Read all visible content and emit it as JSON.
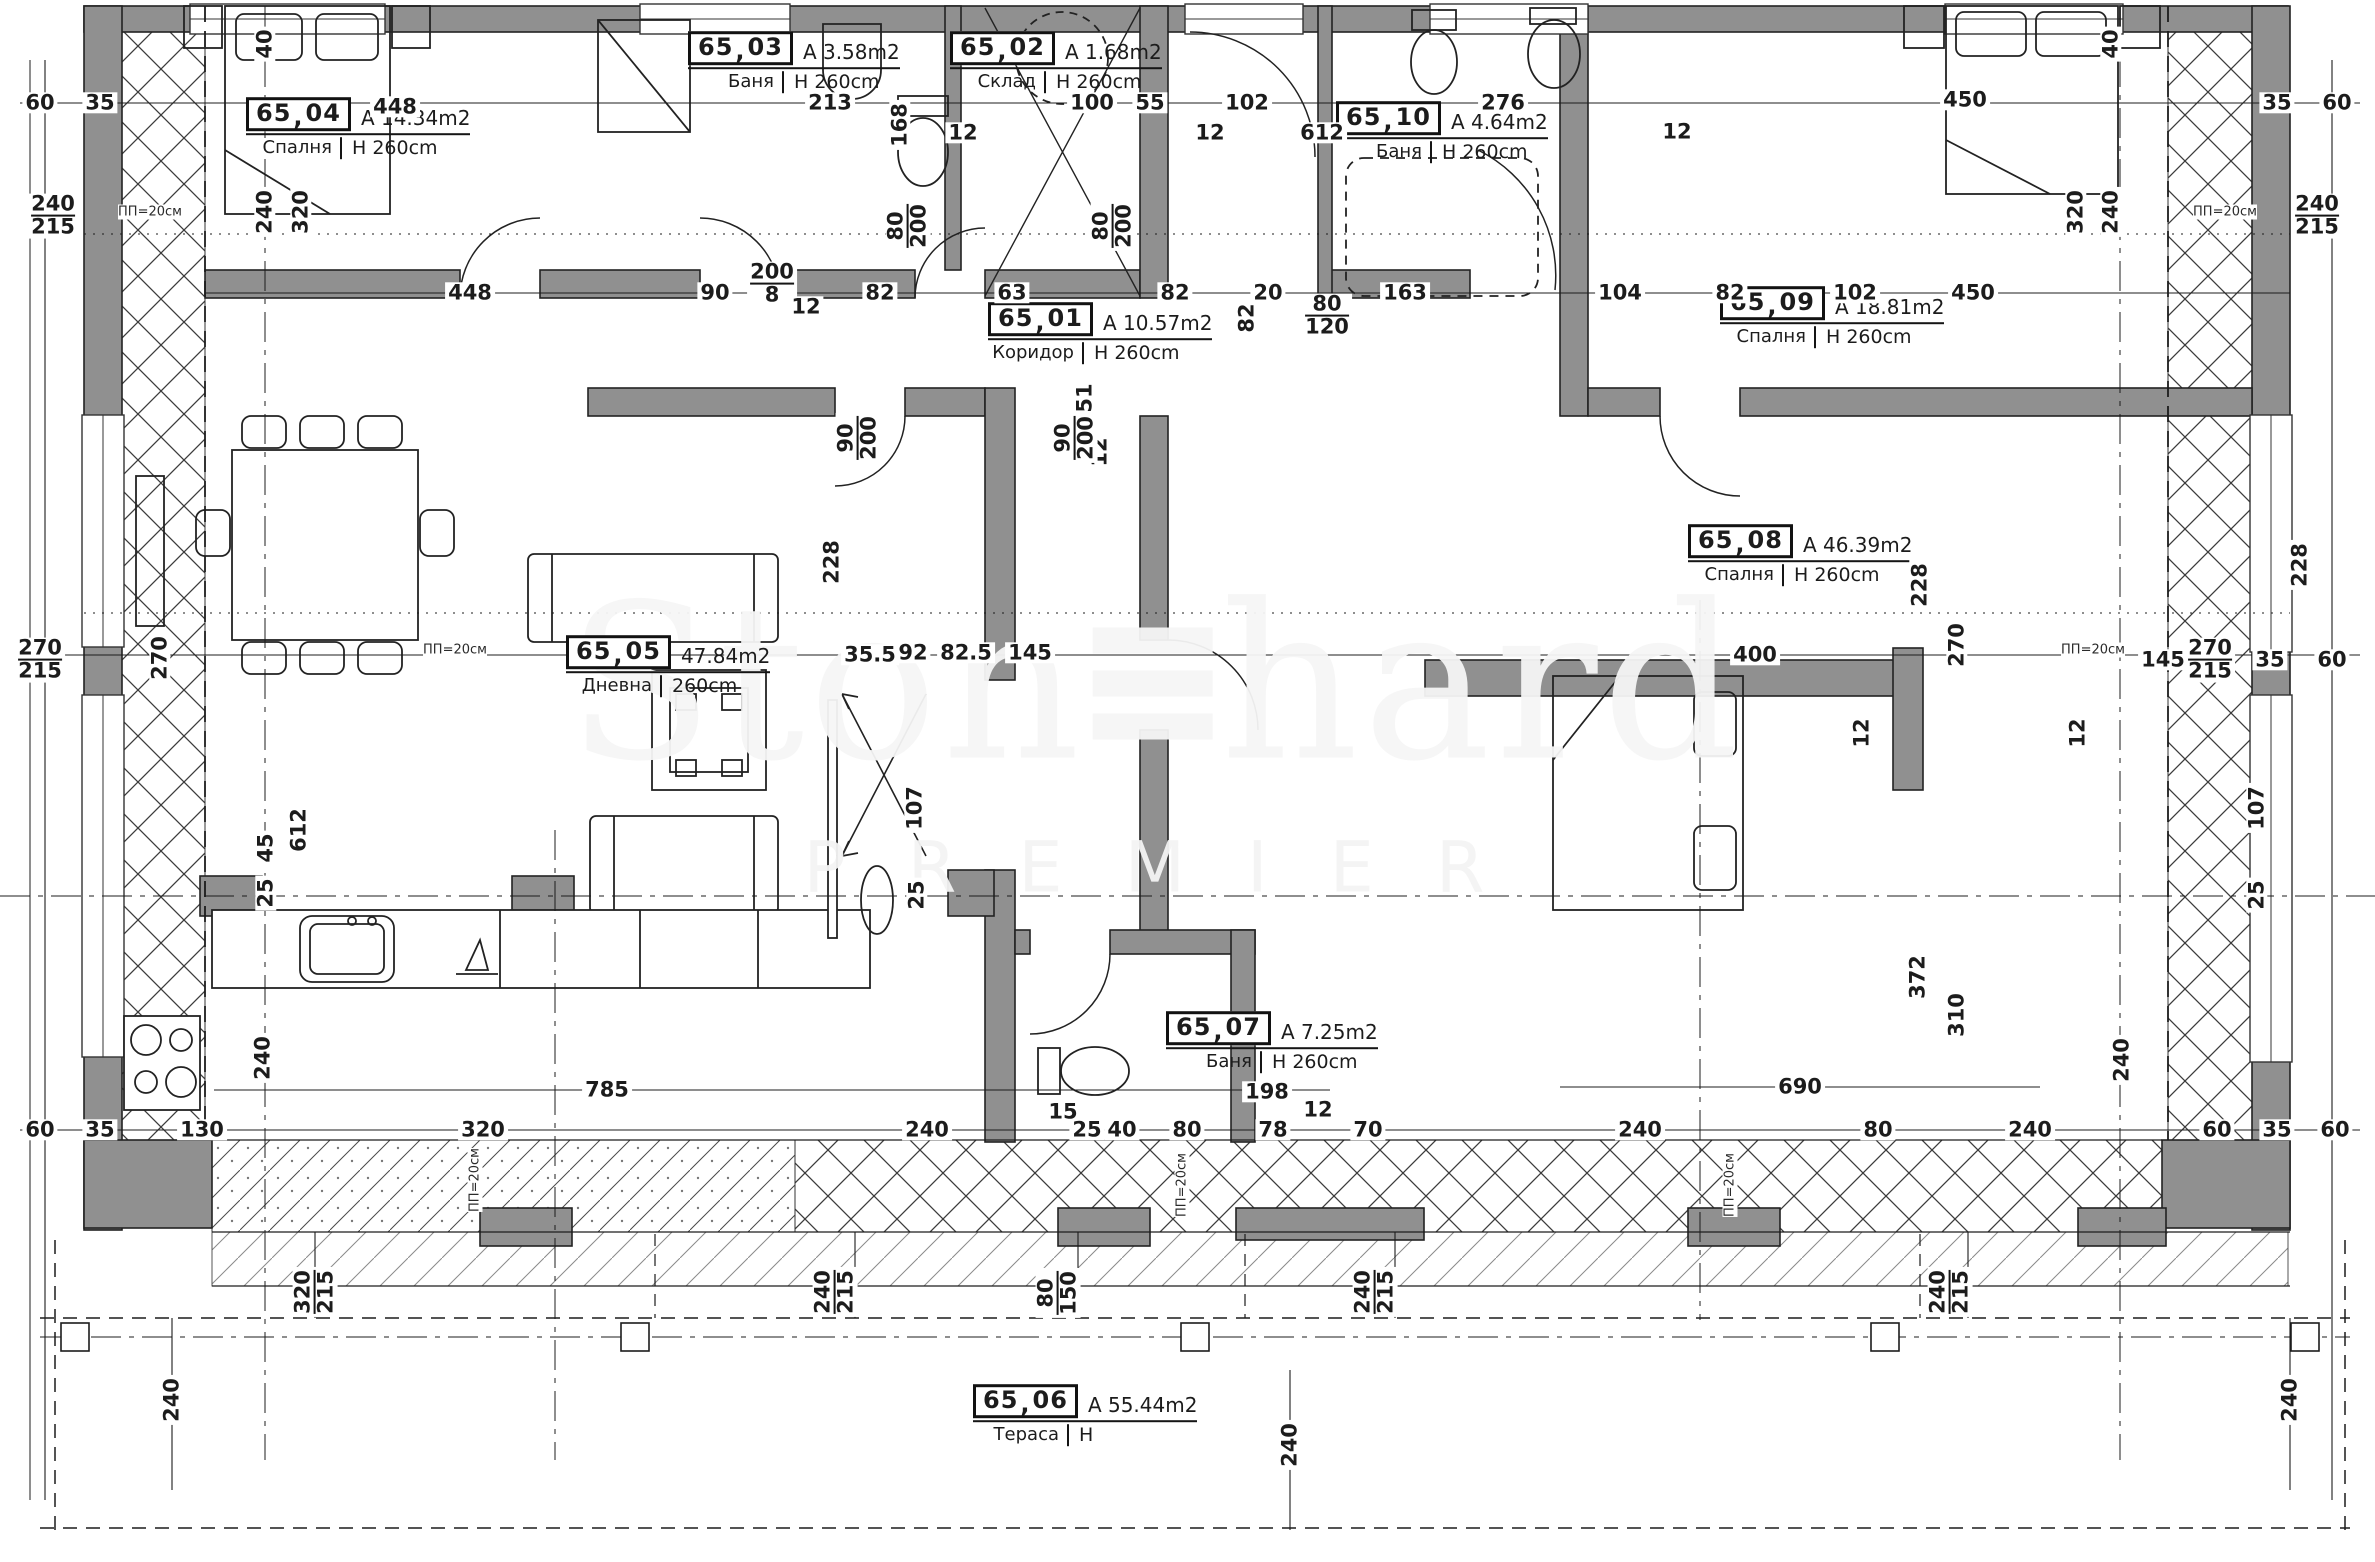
{
  "watermark": {
    "part1": "Ston",
    "part2": "hard",
    "subtitle": "PREMIER"
  },
  "colors": {
    "wall": "#909090",
    "line": "#1c1c1c",
    "watermark": "#f3f3f3",
    "background": "#ffffff"
  },
  "rooms": [
    {
      "id": "65_04",
      "number": "65",
      "suffix": "04",
      "area": "A  14.34m2",
      "name": "Спалня",
      "height": "H  260cm",
      "x": 258,
      "y": 128
    },
    {
      "id": "65_03",
      "number": "65",
      "suffix": "03",
      "area": "A  3.58m2",
      "name": "Баня",
      "height": "H  260cm",
      "x": 700,
      "y": 62
    },
    {
      "id": "65_02",
      "number": "65",
      "suffix": "02",
      "area": "A  1.68m2",
      "name": "Склад",
      "height": "H  260cm",
      "x": 962,
      "y": 62
    },
    {
      "id": "65_01",
      "number": "65",
      "suffix": "01",
      "area": "A  10.57m2",
      "name": "Коридор",
      "height": "H  260cm",
      "x": 1000,
      "y": 333
    },
    {
      "id": "65_10",
      "number": "65",
      "suffix": "10",
      "area": "A  4.64m2",
      "name": "Баня",
      "height": "H  260cm",
      "x": 1348,
      "y": 132
    },
    {
      "id": "65_09",
      "number": "65",
      "suffix": "09",
      "area": "A  18.81m2",
      "name": "Спалня",
      "height": "H  260cm",
      "x": 1732,
      "y": 317
    },
    {
      "id": "65_08",
      "number": "65",
      "suffix": "08",
      "area": "A  46.39m2",
      "name": "Спалня",
      "height": "H  260cm",
      "x": 1700,
      "y": 555
    },
    {
      "id": "65_05",
      "number": "65",
      "suffix": "05",
      "area": "47.84m2",
      "name": "Дневна",
      "height": "260cm",
      "x": 578,
      "y": 666
    },
    {
      "id": "65_07",
      "number": "65",
      "suffix": "07",
      "area": "A  7.25m2",
      "name": "Баня",
      "height": "H  260cm",
      "x": 1178,
      "y": 1042
    },
    {
      "id": "65_06",
      "number": "65",
      "suffix": "06",
      "area": "A 55.44m2",
      "name": "Тераса",
      "height": "H",
      "x": 985,
      "y": 1415
    }
  ],
  "dimensions": [
    {
      "v": "60",
      "x": 40,
      "y": 103
    },
    {
      "v": "35",
      "x": 100,
      "y": 103
    },
    {
      "v": "448",
      "x": 395,
      "y": 107
    },
    {
      "v": "213",
      "x": 830,
      "y": 103
    },
    {
      "v": "168",
      "x": 900,
      "y": 125,
      "r": 1
    },
    {
      "v": "100",
      "x": 1092,
      "y": 103
    },
    {
      "v": "55",
      "x": 1150,
      "y": 103
    },
    {
      "v": "102",
      "x": 1247,
      "y": 103
    },
    {
      "v": "612",
      "x": 1322,
      "y": 133
    },
    {
      "v": "12",
      "x": 963,
      "y": 133
    },
    {
      "v": "12",
      "x": 1210,
      "y": 133
    },
    {
      "v": "12",
      "x": 1677,
      "y": 132
    },
    {
      "v": "276",
      "x": 1503,
      "y": 103
    },
    {
      "v": "450",
      "x": 1965,
      "y": 100
    },
    {
      "v": "35",
      "x": 2277,
      "y": 103
    },
    {
      "v": "60",
      "x": 2337,
      "y": 103
    },
    {
      "v": "240",
      "v2": "215",
      "x": 53,
      "y": 216
    },
    {
      "v": "40",
      "x": 265,
      "y": 44,
      "r": 1
    },
    {
      "v": "240",
      "x": 265,
      "y": 212,
      "r": 1
    },
    {
      "v": "320",
      "x": 301,
      "y": 212,
      "r": 1
    },
    {
      "v": "320",
      "x": 2076,
      "y": 212,
      "r": 1
    },
    {
      "v": "240",
      "x": 2111,
      "y": 212,
      "r": 1
    },
    {
      "v": "40",
      "x": 2111,
      "y": 44,
      "r": 1
    },
    {
      "v": "240",
      "v2": "215",
      "x": 2317,
      "y": 216
    },
    {
      "v": "80",
      "v2": "200",
      "x": 908,
      "y": 226,
      "r": 1
    },
    {
      "v": "80",
      "v2": "200",
      "x": 1113,
      "y": 226,
      "r": 1
    },
    {
      "v": "448",
      "x": 470,
      "y": 293
    },
    {
      "v": "90",
      "x": 715,
      "y": 293
    },
    {
      "v": "82",
      "x": 880,
      "y": 293
    },
    {
      "v": "63",
      "x": 1012,
      "y": 293
    },
    {
      "v": "82",
      "x": 1175,
      "y": 293
    },
    {
      "v": "20",
      "x": 1268,
      "y": 293
    },
    {
      "v": "163",
      "x": 1405,
      "y": 293
    },
    {
      "v": "104",
      "x": 1620,
      "y": 293
    },
    {
      "v": "82",
      "x": 1730,
      "y": 293
    },
    {
      "v": "102",
      "x": 1855,
      "y": 293
    },
    {
      "v": "450",
      "x": 1973,
      "y": 293
    },
    {
      "v": "200",
      "v2": "8",
      "x": 772,
      "y": 284
    },
    {
      "v": "12",
      "x": 806,
      "y": 307
    },
    {
      "v": "80",
      "v2": "120",
      "x": 1327,
      "y": 316
    },
    {
      "v": "82",
      "x": 1247,
      "y": 318,
      "r": 1
    },
    {
      "v": "51",
      "x": 1085,
      "y": 398,
      "r": 1
    },
    {
      "v": "12",
      "x": 1100,
      "y": 452,
      "r": 1
    },
    {
      "v": "90",
      "v2": "200",
      "x": 858,
      "y": 438,
      "r": 1
    },
    {
      "v": "90",
      "v2": "200",
      "x": 1075,
      "y": 438,
      "r": 1
    },
    {
      "v": "270",
      "v2": "215",
      "x": 40,
      "y": 660
    },
    {
      "v": "270",
      "x": 160,
      "y": 658,
      "r": 1
    },
    {
      "v": "612",
      "x": 299,
      "y": 830,
      "r": 1
    },
    {
      "v": "45",
      "x": 266,
      "y": 848,
      "r": 1
    },
    {
      "v": "25",
      "x": 266,
      "y": 893,
      "r": 1
    },
    {
      "v": "240",
      "x": 263,
      "y": 1058,
      "r": 1
    },
    {
      "v": "35.5",
      "x": 870,
      "y": 655
    },
    {
      "v": "92",
      "x": 913,
      "y": 653
    },
    {
      "v": "82.5",
      "x": 966,
      "y": 653
    },
    {
      "v": "145",
      "x": 1030,
      "y": 653
    },
    {
      "v": "400",
      "x": 1755,
      "y": 655
    },
    {
      "v": "145",
      "x": 2163,
      "y": 660
    },
    {
      "v": "270",
      "v2": "215",
      "x": 2210,
      "y": 660
    },
    {
      "v": "35",
      "x": 2270,
      "y": 660
    },
    {
      "v": "60",
      "x": 2332,
      "y": 660
    },
    {
      "v": "270",
      "x": 1957,
      "y": 645,
      "r": 1
    },
    {
      "v": "228",
      "x": 832,
      "y": 562,
      "r": 1
    },
    {
      "v": "228",
      "x": 1920,
      "y": 585,
      "r": 1
    },
    {
      "v": "228",
      "x": 2300,
      "y": 565,
      "r": 1
    },
    {
      "v": "107",
      "x": 915,
      "y": 808,
      "r": 1
    },
    {
      "v": "25",
      "x": 917,
      "y": 895,
      "r": 1
    },
    {
      "v": "107",
      "x": 2257,
      "y": 808,
      "r": 1
    },
    {
      "v": "25",
      "x": 2257,
      "y": 895,
      "r": 1
    },
    {
      "v": "12",
      "x": 1862,
      "y": 733,
      "r": 1
    },
    {
      "v": "12",
      "x": 2078,
      "y": 733,
      "r": 1
    },
    {
      "v": "785",
      "x": 607,
      "y": 1090
    },
    {
      "v": "198",
      "x": 1267,
      "y": 1092
    },
    {
      "v": "690",
      "x": 1800,
      "y": 1087
    },
    {
      "v": "15",
      "x": 1063,
      "y": 1112
    },
    {
      "v": "12",
      "x": 1318,
      "y": 1110
    },
    {
      "v": "130",
      "x": 202,
      "y": 1130
    },
    {
      "v": "320",
      "x": 483,
      "y": 1130
    },
    {
      "v": "240",
      "x": 927,
      "y": 1130
    },
    {
      "v": "25",
      "x": 1087,
      "y": 1130
    },
    {
      "v": "40",
      "x": 1122,
      "y": 1130
    },
    {
      "v": "80",
      "x": 1187,
      "y": 1130
    },
    {
      "v": "78",
      "x": 1273,
      "y": 1130
    },
    {
      "v": "70",
      "x": 1368,
      "y": 1130
    },
    {
      "v": "240",
      "x": 1640,
      "y": 1130
    },
    {
      "v": "80",
      "x": 1878,
      "y": 1130
    },
    {
      "v": "240",
      "x": 2030,
      "y": 1130
    },
    {
      "v": "60",
      "x": 40,
      "y": 1130
    },
    {
      "v": "35",
      "x": 100,
      "y": 1130
    },
    {
      "v": "60",
      "x": 2217,
      "y": 1130
    },
    {
      "v": "35",
      "x": 2277,
      "y": 1130
    },
    {
      "v": "60",
      "x": 2335,
      "y": 1130
    },
    {
      "v": "372",
      "x": 1918,
      "y": 977,
      "r": 1
    },
    {
      "v": "310",
      "x": 1957,
      "y": 1015,
      "r": 1
    },
    {
      "v": "240",
      "x": 2122,
      "y": 1060,
      "r": 1
    },
    {
      "v": "320",
      "v2": "215",
      "x": 315,
      "y": 1292,
      "r": 1
    },
    {
      "v": "240",
      "v2": "215",
      "x": 835,
      "y": 1292,
      "r": 1
    },
    {
      "v": "80",
      "v2": "150",
      "x": 1058,
      "y": 1293,
      "r": 1
    },
    {
      "v": "240",
      "v2": "215",
      "x": 1375,
      "y": 1292,
      "r": 1
    },
    {
      "v": "240",
      "v2": "215",
      "x": 1950,
      "y": 1292,
      "r": 1
    },
    {
      "v": "240",
      "x": 172,
      "y": 1400,
      "r": 1
    },
    {
      "v": "240",
      "x": 1290,
      "y": 1445,
      "r": 1
    },
    {
      "v": "240",
      "x": 2290,
      "y": 1400,
      "r": 1
    }
  ],
  "notes": [
    {
      "t": "ПП=20см",
      "x": 150,
      "y": 212
    },
    {
      "t": "ПП=20см",
      "x": 2225,
      "y": 212
    },
    {
      "t": "ПП=20см",
      "x": 455,
      "y": 650
    },
    {
      "t": "ПП=20см",
      "x": 2093,
      "y": 650
    },
    {
      "t": "ПП=20см",
      "x": 475,
      "y": 1180,
      "r": 1
    },
    {
      "t": "ПП=20см",
      "x": 1182,
      "y": 1185,
      "r": 1
    },
    {
      "t": "ПП=20см",
      "x": 1730,
      "y": 1185,
      "r": 1
    }
  ]
}
